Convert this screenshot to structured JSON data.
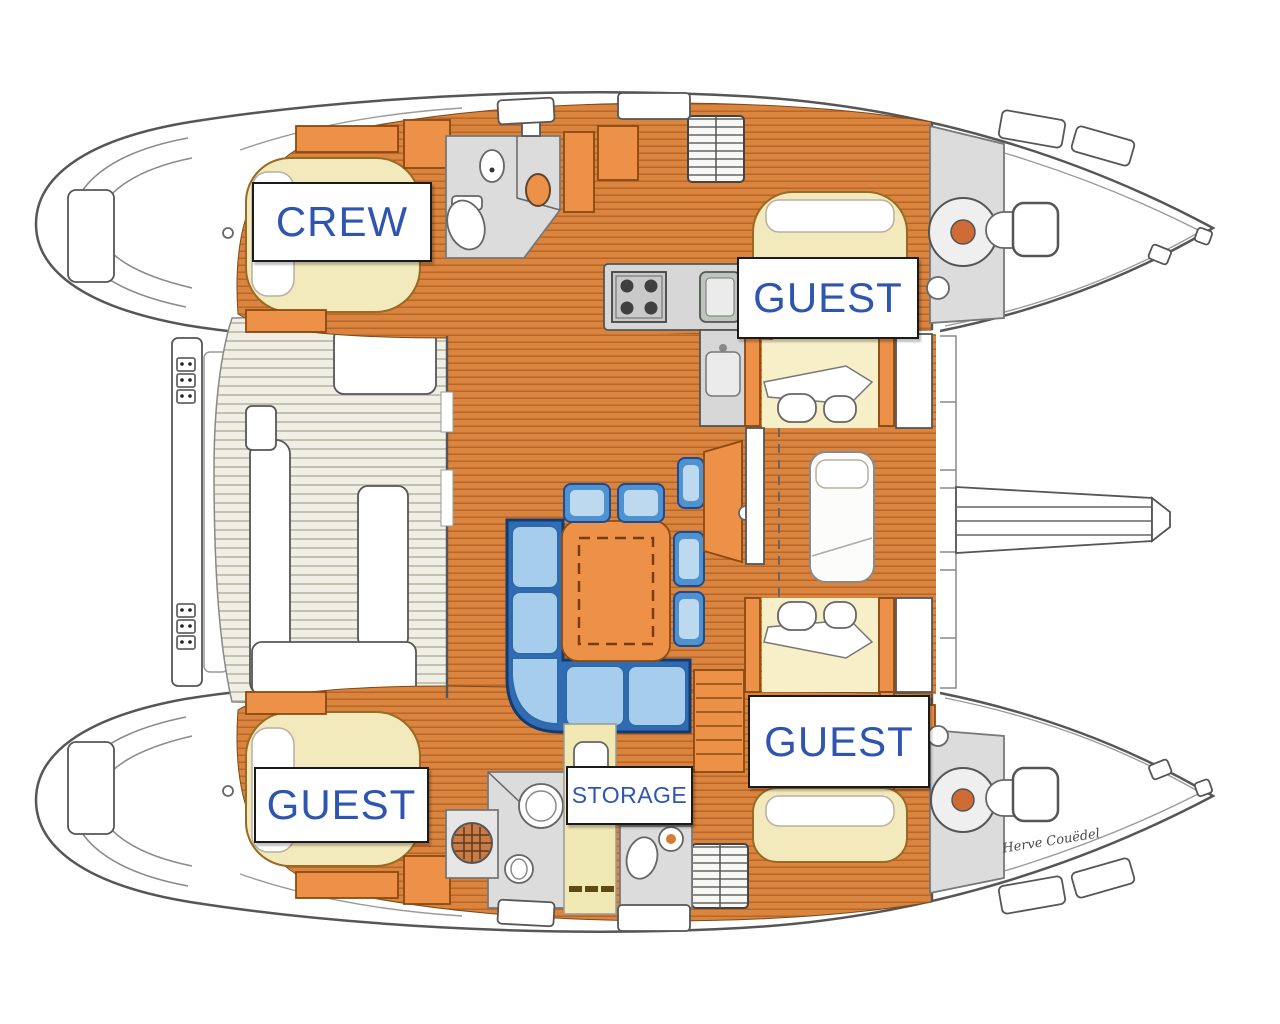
{
  "image": {
    "width": 1280,
    "height": 1024,
    "background": "#ffffff"
  },
  "diagram": {
    "type": "floor-plan",
    "subject": "Catamaran yacht interior layout, top view",
    "labels": {
      "crew": "CREW",
      "guest_top": "GUEST",
      "guest_bottom_right": "GUEST",
      "guest_bottom_left": "GUEST",
      "storage": "STORAGE"
    },
    "signature": "Herve Couëdel",
    "colors": {
      "label_text": "#2e55b0",
      "label_border": "#1b1b1b",
      "outline": "#565656",
      "floor_orange": "#d9853f",
      "floor_stripe": "#bb6526",
      "furniture_orange": "#ec9147",
      "bed_cream": "#f2e9bc",
      "corridor_yellow": "#f0e9b4",
      "bathroom_gray": "#dcdcdc",
      "sofa_blue": "#2f6cb3",
      "sofa_light": "#a6cdec",
      "sofa_dark": "#143a6e",
      "deck_slat": "#f0efe5",
      "deck_slat_line": "#c3c2b0",
      "accent_rust": "#cf6b35",
      "signature_ink": "#4a4a4a"
    }
  }
}
